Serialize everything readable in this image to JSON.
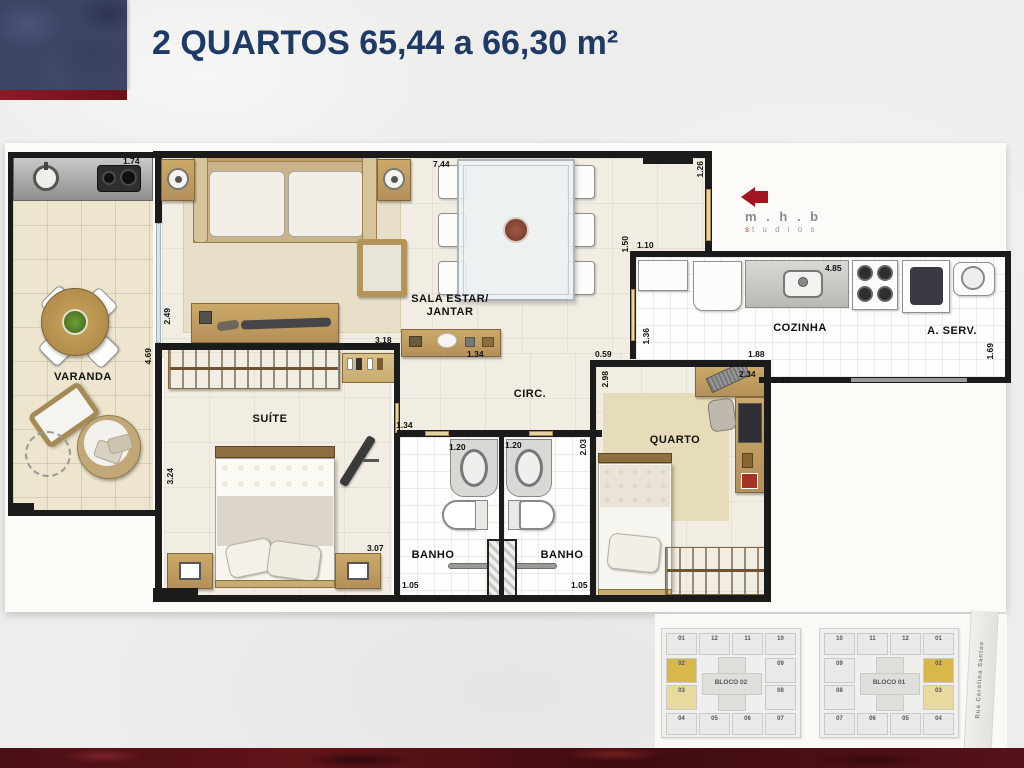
{
  "title": "2 QUARTOS 65,44 a 66,30 m²",
  "logo": {
    "name": "m . h . b",
    "tag_first": "s",
    "tag_rest": "t u d i o s"
  },
  "rooms": {
    "varanda": "VARANDA",
    "sala_line1": "SALA ESTAR/",
    "sala_line2": "JANTAR",
    "circ": "CIRC.",
    "cozinha": "COZINHA",
    "aserv": "A. SERV.",
    "suite": "SUÍTE",
    "banho": "BANHO",
    "quarto": "QUARTO"
  },
  "dims": {
    "varanda_counter": "1.74",
    "sala_top": "7.44",
    "entry_wall": "1.26",
    "varanda_right_a": "2.49",
    "varanda_right_b": "4.69",
    "suite_left": "3.24",
    "kitchen_pass": "1.10",
    "kitchen_left": "1.50",
    "kitchen_counter": "4.85",
    "kitchen_door": "1.36",
    "circ_opening": "0.59",
    "kitchen_b1": "1.88",
    "quarto_desk": "2.34",
    "kitchen_bottom": "2.97",
    "aserv_right": "1.69",
    "sala_cab": "3.18",
    "sideboard": "1.34",
    "suite_door": "1.34",
    "banho1_w": "1.20",
    "banho2_w": "1.20",
    "banho_right": "2.03",
    "quarto_left": "2.98",
    "suite_bottom": "3.07",
    "banho1_b": "1.05",
    "banho2_b": "1.05"
  },
  "minimap": {
    "street": "Rua Carolina Santos",
    "blocks": [
      {
        "label": "BLOCO 02",
        "top": [
          "01",
          "12",
          "11",
          "10"
        ],
        "left": [
          "02",
          "03"
        ],
        "right": [
          "09",
          "08"
        ],
        "bottom": [
          "04",
          "05",
          "06",
          "07"
        ],
        "highlight": [
          "02",
          "03"
        ]
      },
      {
        "label": "BLOCO 01",
        "top": [
          "10",
          "11",
          "12",
          "01"
        ],
        "left": [
          "09",
          "08"
        ],
        "right": [
          "02",
          "03"
        ],
        "bottom": [
          "07",
          "06",
          "05",
          "04"
        ],
        "highlight": [
          "02",
          "03"
        ]
      }
    ]
  },
  "colors": {
    "accent_navy": "#1F3A64",
    "accent_red": "#8E1A24",
    "highlight_gold": "#D8B84A"
  }
}
